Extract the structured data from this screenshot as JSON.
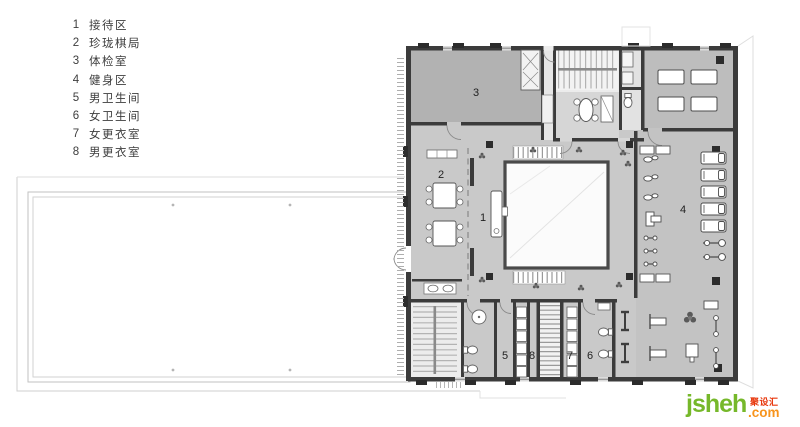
{
  "legend": {
    "items": [
      {
        "num": "1",
        "label": "接待区"
      },
      {
        "num": "2",
        "label": "珍珑棋局"
      },
      {
        "num": "3",
        "label": "体检室"
      },
      {
        "num": "4",
        "label": "健身区"
      },
      {
        "num": "5",
        "label": "男卫生间"
      },
      {
        "num": "6",
        "label": "女卫生间"
      },
      {
        "num": "7",
        "label": "女更衣室"
      },
      {
        "num": "8",
        "label": "男更衣室"
      }
    ]
  },
  "plan": {
    "labels": [
      {
        "room": "physical-exam-room",
        "num": "3"
      },
      {
        "room": "chess-area",
        "num": "2"
      },
      {
        "room": "reception",
        "num": "1"
      },
      {
        "room": "fitness-area",
        "num": "4"
      },
      {
        "room": "mens-toilet",
        "num": "5"
      },
      {
        "room": "mens-locker-room",
        "num": "8"
      },
      {
        "room": "womens-locker-room",
        "num": "7"
      },
      {
        "room": "womens-toilet",
        "num": "6"
      }
    ]
  },
  "watermark": {
    "brand": "jsheh",
    "cn": "聚设汇",
    "tld": ".com"
  },
  "colors": {
    "floor": "#c9c9c9",
    "room_dark": "#b2b2b2",
    "wall": "#3b3b3b",
    "atrium_border": "#4a4a4a",
    "brand_green": "#76b82a",
    "brand_orange": "#f7941d",
    "brand_red": "#e8380d"
  }
}
